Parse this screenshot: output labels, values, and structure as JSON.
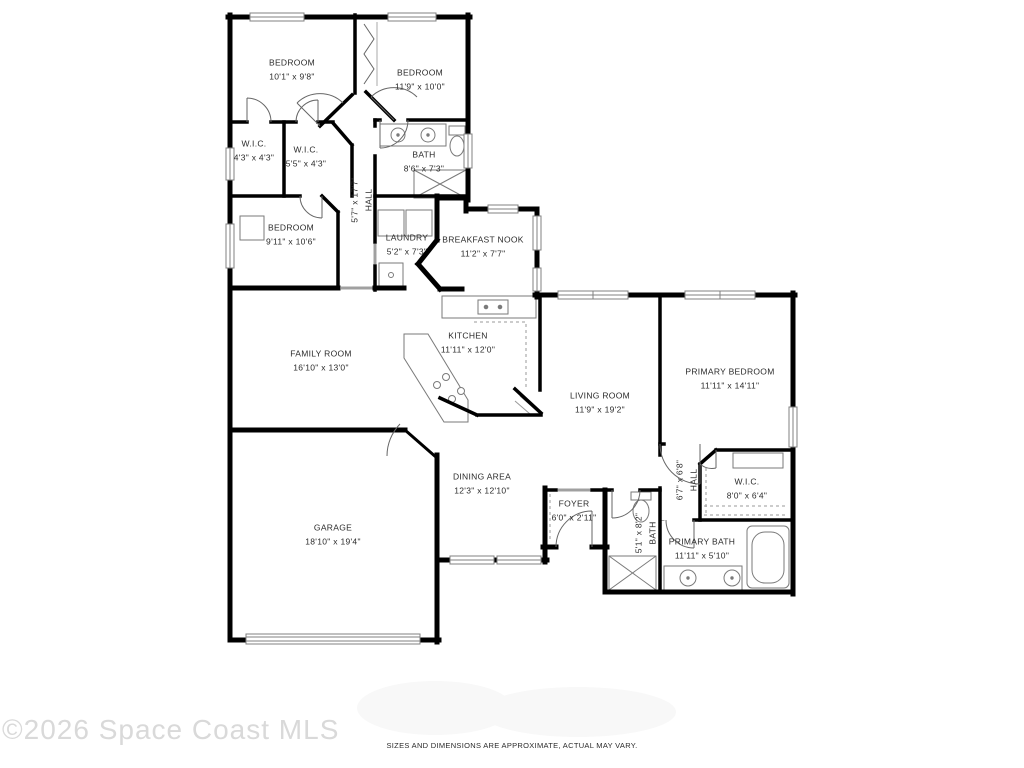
{
  "meta": {
    "type": "residential-floor-plan",
    "wall_color": "#000000",
    "label_color": "#2b2b2b",
    "fixture_stroke": "#7a7a7a",
    "watermark_color": "#d9d9d9"
  },
  "watermark": "©2026 Space Coast MLS",
  "disclaimer": "SIZES AND DIMENSIONS ARE APPROXIMATE, ACTUAL MAY VARY.",
  "rooms": [
    {
      "name": "BEDROOM",
      "dims": "10'1\" x 9'8\""
    },
    {
      "name": "BEDROOM",
      "dims": "11'9\" x 10'0\""
    },
    {
      "name": "W.I.C.",
      "dims": "4'3\" x 4'3\""
    },
    {
      "name": "W.I.C.",
      "dims": "5'5\" x 4'3\""
    },
    {
      "name": "BATH",
      "dims": "8'6\" x 7'3\""
    },
    {
      "name": "HALL",
      "dims": "5'7\" x 17'7\""
    },
    {
      "name": "BEDROOM",
      "dims": "9'11\" x 10'6\""
    },
    {
      "name": "LAUNDRY",
      "dims": "5'2\" x 7'3\""
    },
    {
      "name": "BREAKFAST NOOK",
      "dims": "11'2\" x 7'7\""
    },
    {
      "name": "KITCHEN",
      "dims": "11'11\" x 12'0\""
    },
    {
      "name": "FAMILY ROOM",
      "dims": "16'10\" x 13'0\""
    },
    {
      "name": "LIVING ROOM",
      "dims": "11'9\" x 19'2\""
    },
    {
      "name": "PRIMARY BEDROOM",
      "dims": "11'11\" x 14'11\""
    },
    {
      "name": "DINING AREA",
      "dims": "12'3\" x 12'10\""
    },
    {
      "name": "GARAGE",
      "dims": "18'10\" x 19'4\""
    },
    {
      "name": "FOYER",
      "dims": "6'0\" x 2'11\""
    },
    {
      "name": "HALL",
      "dims": "6'7\" x 6'8\""
    },
    {
      "name": "W.I.C.",
      "dims": "8'0\" x 6'4\""
    },
    {
      "name": "BATH",
      "dims": "5'1\" x 8'2\""
    },
    {
      "name": "PRIMARY BATH",
      "dims": "11'11\" x 5'10\""
    }
  ]
}
